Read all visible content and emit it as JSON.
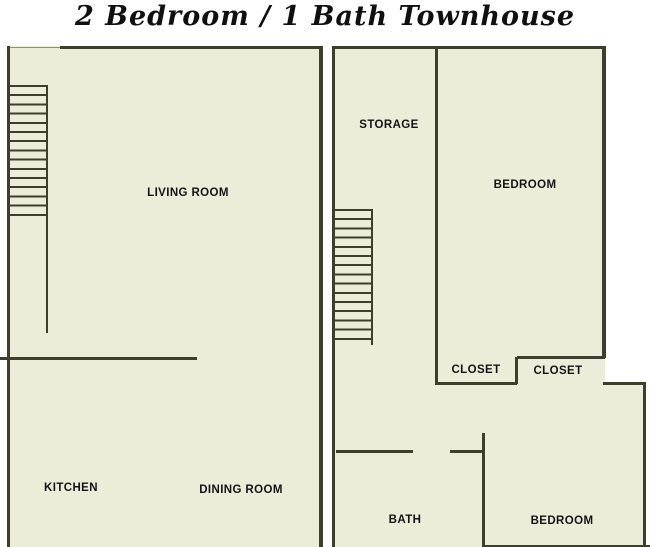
{
  "title": "2 Bedroom / 1 Bath Townhouse",
  "colors": {
    "background": "#ffffff",
    "floor": "#ECEDD9",
    "wall": "#3E3E2C",
    "text": "#141414",
    "title": "#101010"
  },
  "plans": {
    "first_floor": {
      "living_room": "LIVING ROOM",
      "kitchen": "KITCHEN",
      "dining_room": "DINING ROOM"
    },
    "second_floor": {
      "storage": "STORAGE",
      "bedroom_top": "BEDROOM",
      "closet_left": "CLOSET",
      "closet_right": "CLOSET",
      "bath": "BATH",
      "bedroom_bottom": "BEDROOM"
    }
  }
}
